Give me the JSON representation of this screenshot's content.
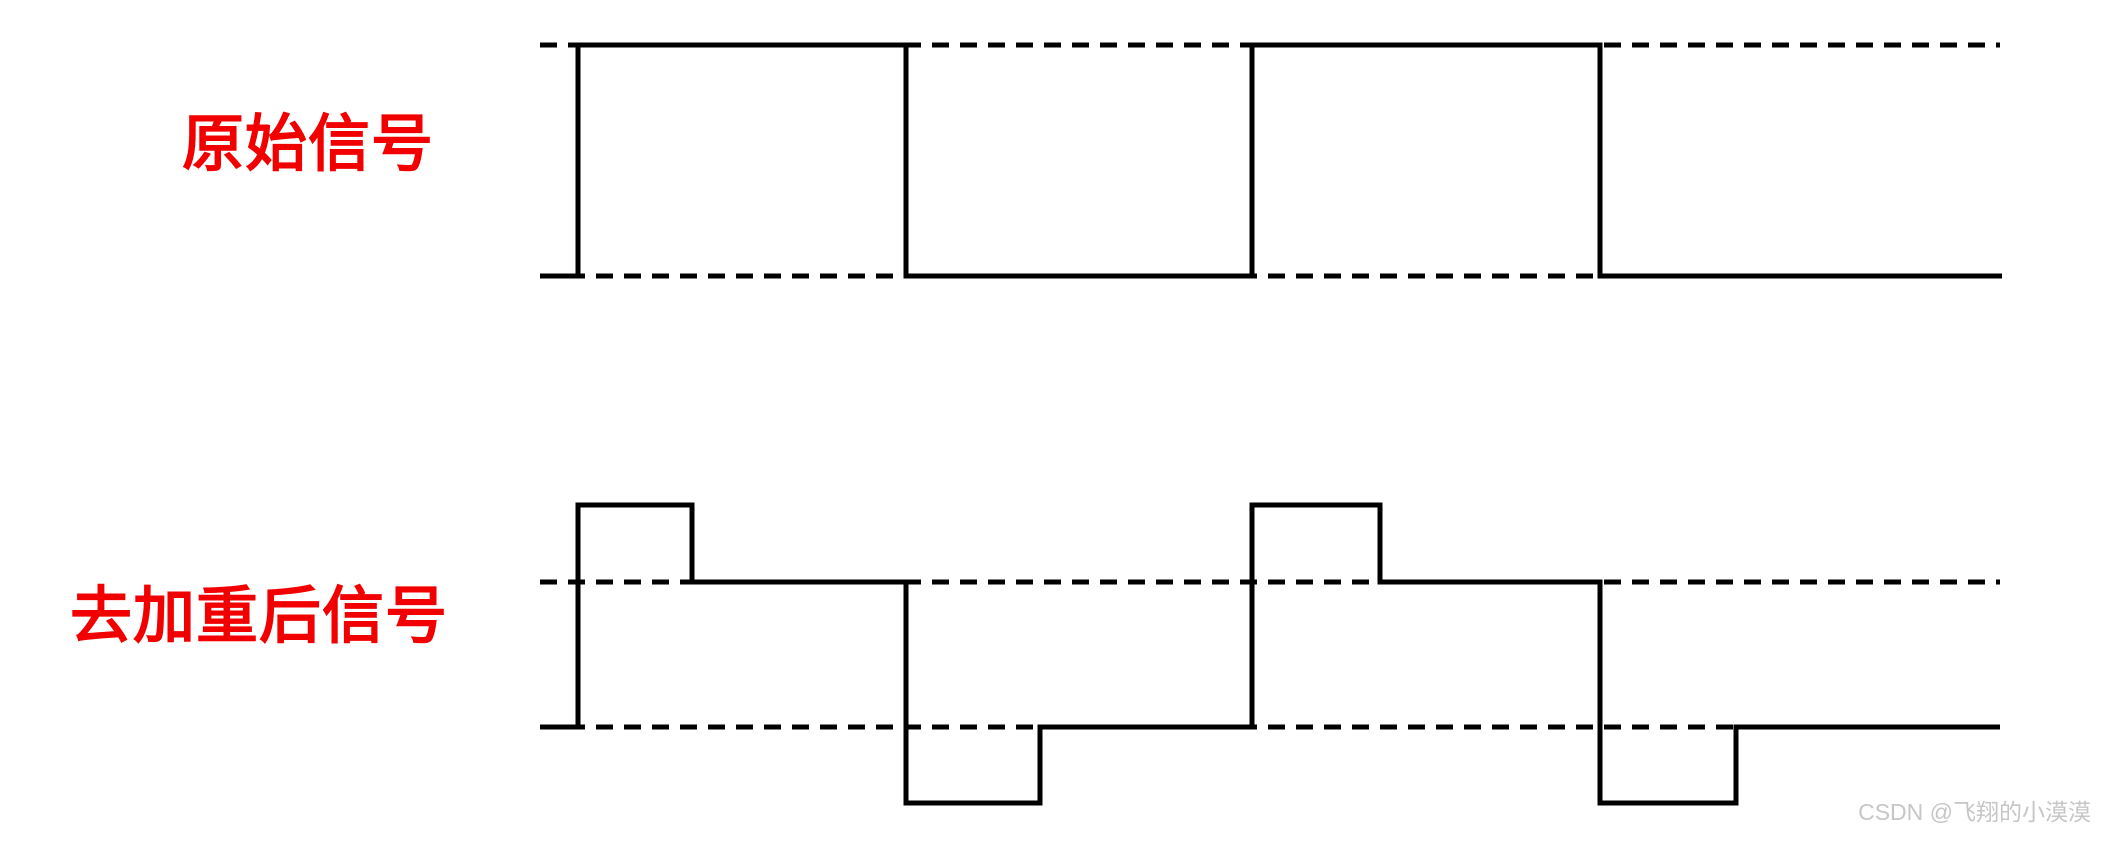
{
  "labels": {
    "original": {
      "text": "原始信号",
      "color": "#f20000"
    },
    "deemphasized": {
      "text": "去加重后信号",
      "color": "#f20000"
    }
  },
  "watermark": {
    "text": "CSDN @飞翔的小漠漠",
    "color": "#c6c6c6"
  },
  "diagram": {
    "line_color": "#000000",
    "stroke_width": 5,
    "dash_pattern": "17 11",
    "x_start": 540,
    "x_end": 2000,
    "waveforms": [
      {
        "name": "original-signal",
        "description": "square wave between two dashed reference levels",
        "dashed_levels": [
          45,
          276
        ],
        "points": [
          [
            540,
            276
          ],
          [
            578,
            276
          ],
          [
            578,
            45
          ],
          [
            906,
            45
          ],
          [
            906,
            276
          ],
          [
            1252,
            276
          ],
          [
            1252,
            45
          ],
          [
            1600,
            45
          ],
          [
            1600,
            276
          ],
          [
            2002,
            276
          ]
        ]
      },
      {
        "name": "deemphasized-signal",
        "description": "square wave with overshoot and undershoot spikes at each transition, dashed lines mark the settled levels",
        "dashed_levels": [
          582,
          727
        ],
        "points": [
          [
            540,
            727
          ],
          [
            578,
            727
          ],
          [
            578,
            505
          ],
          [
            692,
            505
          ],
          [
            692,
            582
          ],
          [
            906,
            582
          ],
          [
            906,
            803
          ],
          [
            1040,
            803
          ],
          [
            1040,
            727
          ],
          [
            1252,
            727
          ],
          [
            1252,
            505
          ],
          [
            1380,
            505
          ],
          [
            1380,
            582
          ],
          [
            1600,
            582
          ],
          [
            1600,
            803
          ],
          [
            1736,
            803
          ],
          [
            1736,
            727
          ],
          [
            2000,
            727
          ]
        ]
      }
    ]
  }
}
